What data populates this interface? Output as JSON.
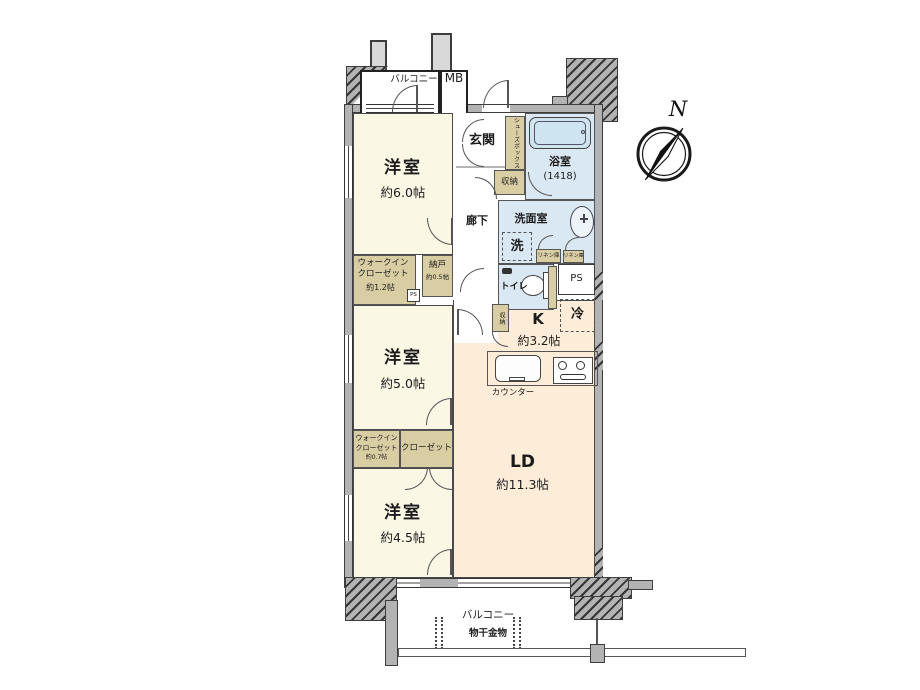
{
  "colors": {
    "wall": "#b3b3b3",
    "wall_line": "#3d3d3d",
    "bedroom_floor": "#fbf7e5",
    "ldk_floor": "#fcecd8",
    "wet_area_floor": "#d9e8f2",
    "storage_fill": "#d9cda3",
    "bathtub_fill": "#cfe4f1",
    "background": "#ffffff"
  },
  "compass": {
    "north": "N"
  },
  "outside": {
    "balcony_top": "バルコニー",
    "meter_box": "MB"
  },
  "rooms": {
    "entrance": {
      "name": "玄関"
    },
    "hallway": {
      "name": "廊下"
    },
    "bathroom": {
      "name": "浴室",
      "size": "(1418)"
    },
    "washroom": {
      "name": "洗面室"
    },
    "toilet": {
      "name": "トイレ"
    },
    "bedroom6": {
      "name": "洋室",
      "size": "約6.0帖"
    },
    "bedroom5": {
      "name": "洋室",
      "size": "約5.0帖"
    },
    "bedroom45": {
      "name": "洋室",
      "size": "約4.5帖"
    },
    "kitchen": {
      "name": "K",
      "size": "約3.2帖"
    },
    "ld": {
      "name": "LD",
      "size": "約11.3帖"
    }
  },
  "storage": {
    "shoes_box": "シューズボックス",
    "entry_closet": "収納",
    "linen_a": "リネン庫",
    "linen_b": "リネン庫",
    "kitchen_closet": "収納",
    "wic_large": {
      "line1": "ウォークイン",
      "line2": "クローゼット",
      "size": "約1.2帖"
    },
    "wic_small": {
      "line1": "ウォークイン",
      "line2": "クローゼット",
      "size": "約0.7帖"
    },
    "nando": {
      "name": "納戸",
      "size": "約0.5帖"
    },
    "closet": "クローゼット"
  },
  "fixtures": {
    "washer": "洗",
    "fridge": "冷",
    "counter": "カウンター",
    "ps_main": "PS",
    "ps_small": "PS"
  },
  "balcony": {
    "label": "バルコニー",
    "laundry": "物干金物"
  }
}
